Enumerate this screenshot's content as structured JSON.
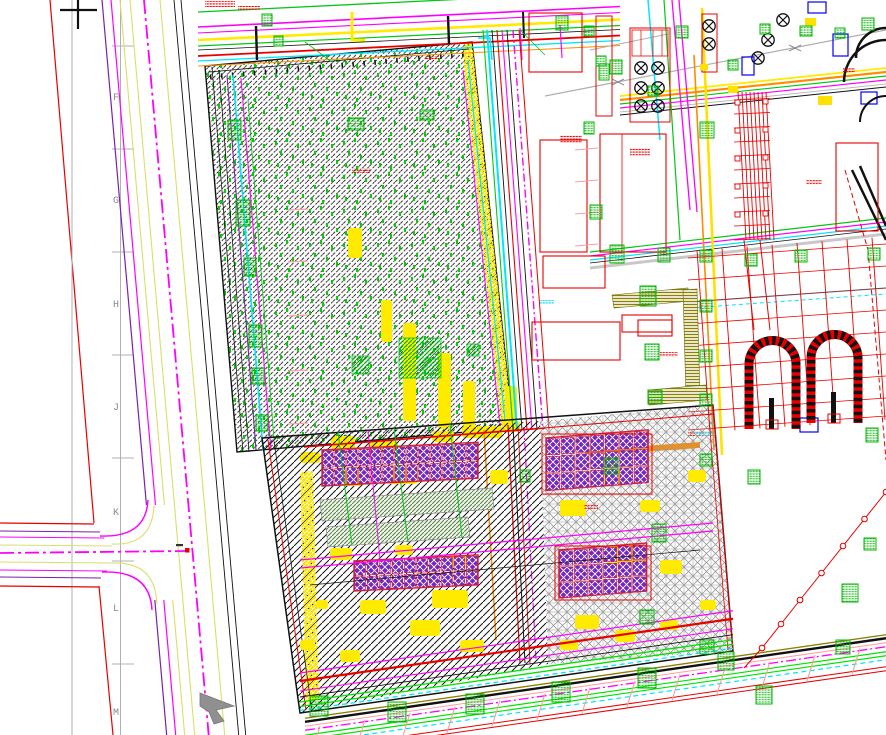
{
  "viewport": {
    "width": 886,
    "height": 735,
    "background": "#FFFFFF",
    "description": "CAD plot plan drawing viewport"
  },
  "survey_grid": {
    "letters": [
      "F",
      "G",
      "H",
      "J",
      "K",
      "L",
      "M"
    ],
    "label_color": "#8A8A8A"
  },
  "cursors": {
    "crosshair": {
      "x": 78,
      "y": 10
    },
    "arrow": {
      "x": 215,
      "y": 708
    }
  },
  "palette": {
    "red": "#E80000",
    "salmon": "#FF9DA0",
    "magenta": "#FF00FF",
    "purple": "#7B21A8",
    "module_purple": "#7426C2",
    "module_border": "#D02040",
    "yellow": "#FFEB00",
    "pale_yellow_green": "#D9E06A",
    "orange": "#FF8C00",
    "olive": "#8B8000",
    "green": "#00C814",
    "bright_green": "#00E300",
    "tag_green": "#00B400",
    "strip_green": "#5C8A4E",
    "cyan": "#00E5FF",
    "blue": "#0000FF",
    "black": "#111111",
    "gray": "#B0B0B0",
    "crosshatch_gray": "#9A9A9A",
    "cursor_gray": "#909090"
  }
}
